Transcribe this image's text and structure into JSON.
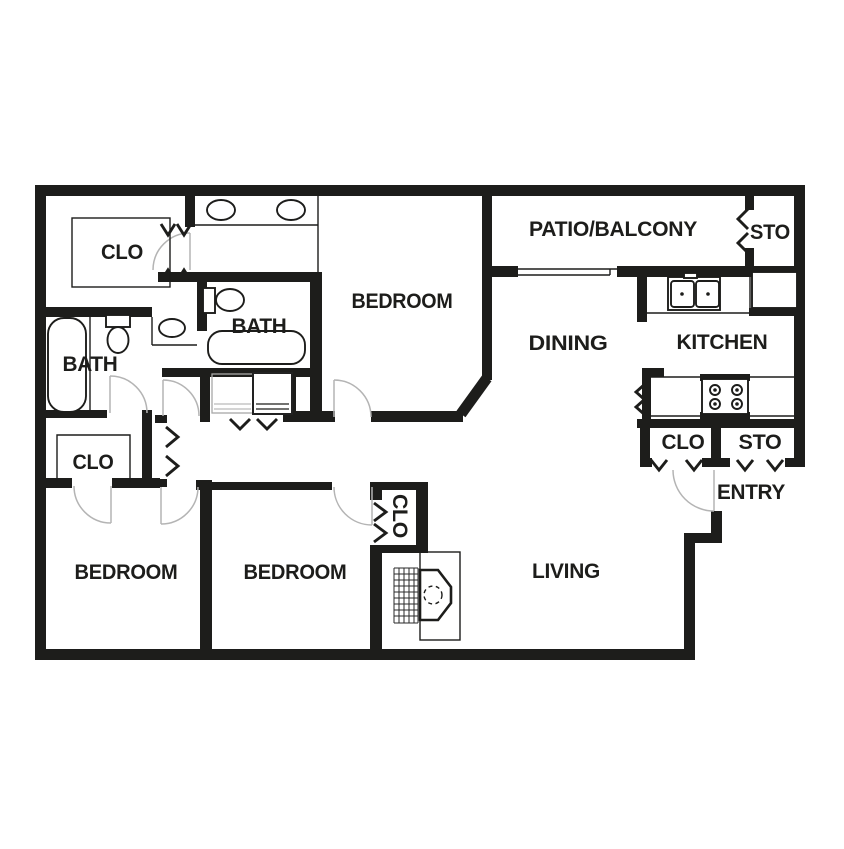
{
  "colors": {
    "wall": "#1d1d1b",
    "background": "#ffffff",
    "door_swing_gray": "#b4b4b4"
  },
  "rooms": {
    "closet_walkin": {
      "label": "CLO"
    },
    "bath_left": {
      "label": "BATH"
    },
    "bath_center": {
      "label": "BATH"
    },
    "bedroom_top": {
      "label": "BEDROOM"
    },
    "patio_balcony": {
      "label": "PATIO/BALCONY"
    },
    "storage_patio": {
      "label": "STO"
    },
    "dining": {
      "label": "DINING"
    },
    "kitchen": {
      "label": "KITCHEN"
    },
    "closet_entry": {
      "label": "CLO"
    },
    "storage_entry": {
      "label": "STO"
    },
    "entry": {
      "label": "ENTRY"
    },
    "closet_hall": {
      "label": "CLO"
    },
    "bedroom_left": {
      "label": "BEDROOM"
    },
    "bedroom_center": {
      "label": "BEDROOM"
    },
    "closet_bedroom_center": {
      "label": "CLO"
    },
    "living": {
      "label": "LIVING"
    }
  },
  "fixtures": [
    "double-vanity-sinks",
    "bathtub-left",
    "toilet-left",
    "pedestal-sink",
    "toilet-center",
    "bathtub-center",
    "washer-dryer",
    "kitchen-double-sink",
    "refrigerator",
    "stove",
    "fireplace",
    "sliding-glass-door"
  ]
}
